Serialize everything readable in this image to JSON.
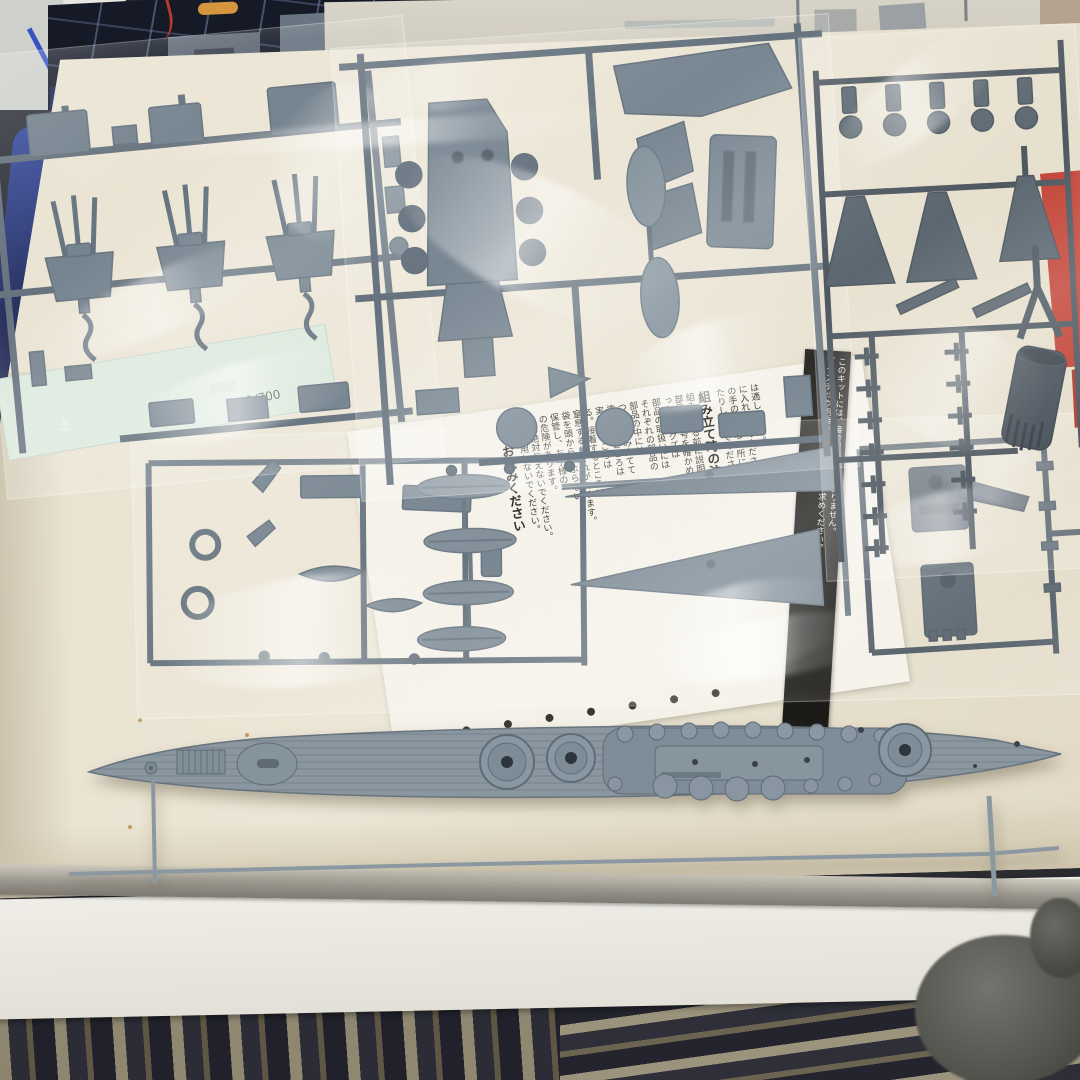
{
  "photo": {
    "subject": "Opened 1/700 scale warship plastic model kit box: grey sprues in clear bags, mint decal sheet, folded instruction sheet with Japanese safety text, and the long deck/hull part at the bottom",
    "decal": {
      "scale_label": "1/700"
    },
    "instructions": {
      "columns": [
        "は適しません。",
        "に入れないでください。",
        "の手の届かない所に",
        "たりしないでください。",
        {
          "t": "組み立て時の注意",
          "big": true
        },
        "組み立てる前に説明書を",
        "部品は番号を確かめて",
        "った後のクズは",
        "部品の取扱いには",
        "それぞれの部品の",
        "部品の中には",
        "つけて組み立てて",
        "塗装するところは",
        "実線のところは",
        "る。接着するところは",
        "窒息するおそれがあります。",
        "袋を頭からかぶらない",
        "保管し、お子様の",
        "の危険があります。",
        "には絶対与えないでください。",
        "では使用しないでください。",
        {
          "t": "必ずお読みください",
          "big": true
        }
      ],
      "banner_lines": [
        "このキットには、接着剤は入っておりません。",
        "プラスチック用接着剤を別にお買い求めください。"
      ]
    },
    "colors": {
      "box_interior": "#e9e2d0",
      "sprue_blue_grey": "#6e7d89",
      "sprue_dark_grey": "#535f69",
      "deck_grey": "#8a97a1",
      "decal_mint": "#dbe8dc",
      "red_accent": "#bf392b",
      "banner_black": "#1d1b18",
      "paper_white": "#f4f1e8",
      "rug_dark": "#262730",
      "blanket_white": "#e9e7e1"
    }
  }
}
